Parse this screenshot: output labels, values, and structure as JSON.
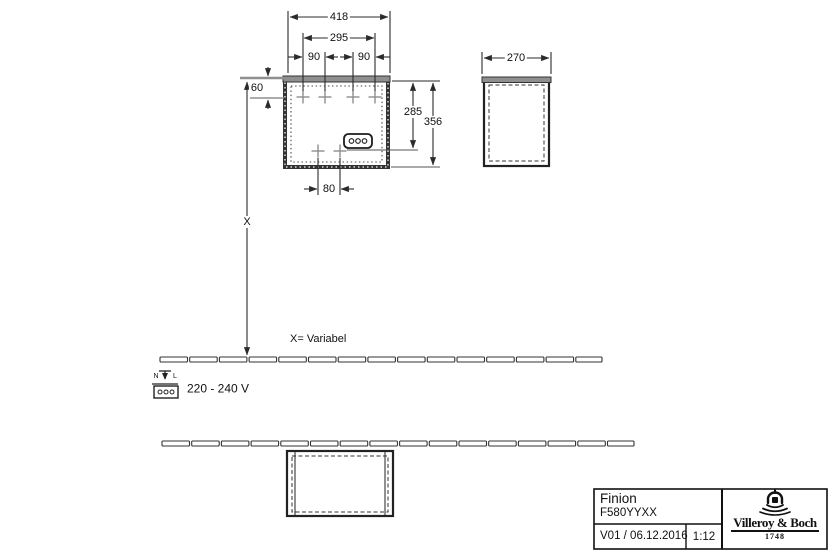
{
  "dimensions": {
    "overall_width": "418",
    "inner_width": "295",
    "hole_spacing_left": "90",
    "hole_spacing_right": "90",
    "top_offset": "60",
    "socket_height": "285",
    "overall_height": "356",
    "depth": "270",
    "bottom_hole_spacing": "80",
    "variable_height": "X"
  },
  "annotations": {
    "variable_note": "X= Variabel",
    "voltage": "220 - 240 V",
    "neutral_label": "N",
    "line_label": "L"
  },
  "title_block": {
    "product_line": "Finion",
    "article_number": "F580YYXX",
    "version_date": "V01 / 06.12.2016",
    "scale": "1:12",
    "brand": "Villeroy & Boch",
    "brand_year": "1748"
  },
  "colors": {
    "line": "#2b2b2b",
    "gray_fill": "#8f8f8f",
    "cross": "#8e8e8e",
    "background": "#ffffff"
  }
}
